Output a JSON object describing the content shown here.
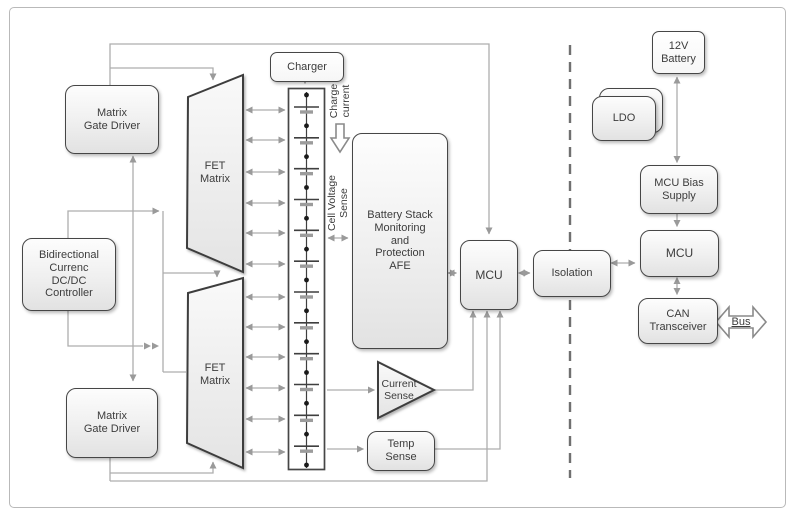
{
  "blocks": {
    "matrix_gate_driver_top": {
      "label": "Matrix\nGate Driver"
    },
    "fet_matrix_top": {
      "label": "FET\nMatrix"
    },
    "bidirectional_controller": {
      "label": "Bidirectional\nCurrenc\nDC/DC\nController"
    },
    "matrix_gate_driver_bottom": {
      "label": "Matrix\nGate Driver"
    },
    "fet_matrix_bottom": {
      "label": "FET\nMatrix"
    },
    "charger": {
      "label": "Charger"
    },
    "battery_stack": {
      "cell_count": 12,
      "tap_count": 12
    },
    "afe": {
      "label": "Battery Stack\nMonitoring\nand\nProtection\nAFE"
    },
    "mcu_primary": {
      "label": "MCU"
    },
    "current_sense": {
      "label": "Current\nSense"
    },
    "temp_sense": {
      "label": "Temp\nSense"
    },
    "isolation": {
      "label": "Isolation"
    },
    "battery_12v": {
      "label": "12V\nBattery"
    },
    "ldo": {
      "label": "LDO"
    },
    "mcu_bias_supply": {
      "label": "MCU Bias\nSupply"
    },
    "mcu_secondary": {
      "label": "MCU"
    },
    "can_transceiver": {
      "label": "CAN\nTransceiver"
    }
  },
  "annotations": {
    "charge_current": "Charge\ncurrent",
    "cell_voltage_sense": "Cell Voltage\nSense",
    "bus": "Bus"
  },
  "colors": {
    "block_border": "#464646",
    "wire": "#adadad",
    "arrowhead": "#9a9a9a",
    "dashed_divider": "#707070",
    "text": "#3c3c3c"
  }
}
